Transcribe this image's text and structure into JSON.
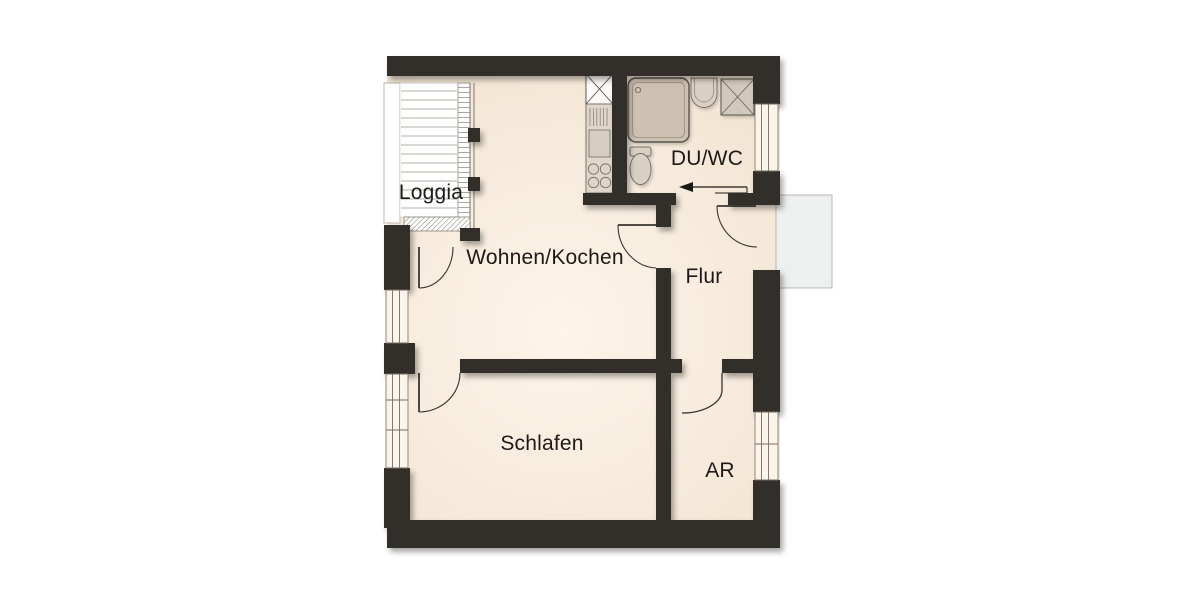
{
  "plan": {
    "type": "apartment-floor-plan",
    "rooms": [
      {
        "name": "loggia",
        "label": "Loggia"
      },
      {
        "name": "wohnen-kochen",
        "label": "Wohnen/Kochen"
      },
      {
        "name": "du-wc",
        "label": "DU/WC"
      },
      {
        "name": "flur",
        "label": "Flur"
      },
      {
        "name": "schlafen",
        "label": "Schlafen"
      },
      {
        "name": "ar",
        "label": "AR"
      }
    ],
    "fixtures": [
      {
        "name": "tall-cabinet-icon"
      },
      {
        "name": "kitchen-counter-icon"
      },
      {
        "name": "kitchen-sink-icon"
      },
      {
        "name": "cooktop-icon"
      },
      {
        "name": "shower-icon"
      },
      {
        "name": "washbasin-icon"
      },
      {
        "name": "washing-machine-icon"
      },
      {
        "name": "toilet-icon"
      },
      {
        "name": "entrance-arrow-icon"
      }
    ],
    "entrance_arrow_direction": "left",
    "colors": {
      "wall": "#322e2a",
      "floor": "#f2e4d2",
      "floor_light": "#fdf5ea",
      "fixture_fill": "#d9d0c4",
      "fixture_dark": "#cdc1b2",
      "window_fill": "#faf4ea",
      "outline": "#756d63",
      "door_line": "#3a3530",
      "landing": "#eef0ef",
      "text": "#1c1a18"
    }
  }
}
